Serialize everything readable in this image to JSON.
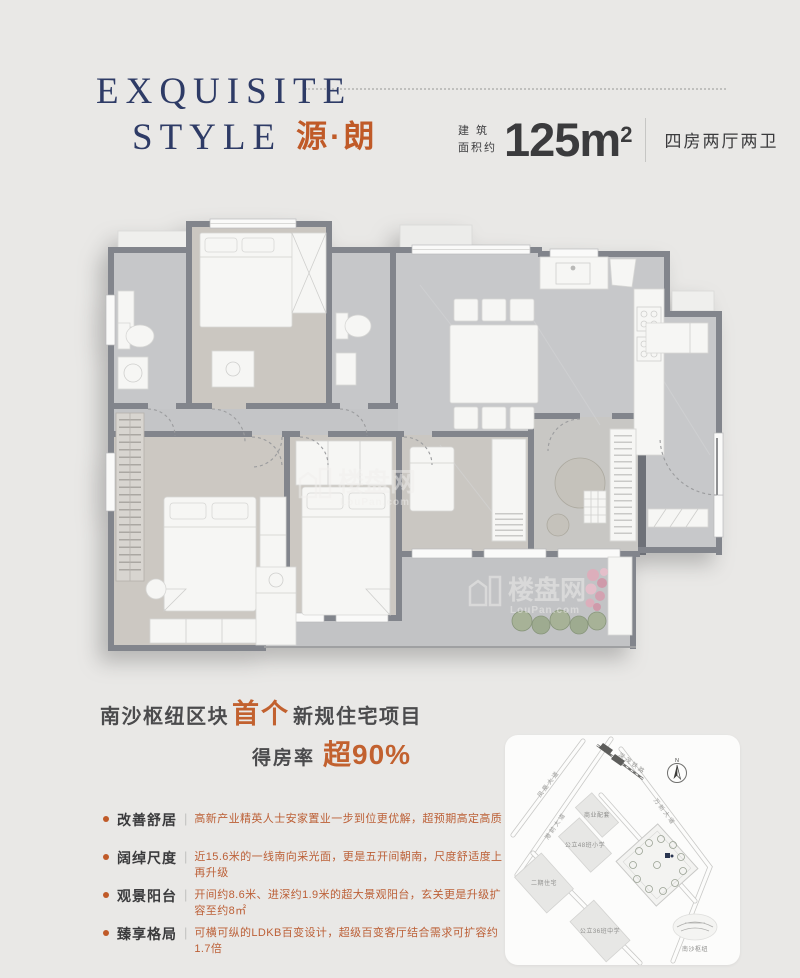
{
  "header": {
    "title_en_1": "EXQUISITE",
    "title_en_2": "STYLE",
    "title_cn": "源·朗",
    "area_prefix_top": "建 筑",
    "area_prefix_bottom": "面积约",
    "area_value": "125m",
    "area_sup": "2",
    "unit_type": "四房两厅两卫"
  },
  "floorplan": {
    "watermark": "楼盘网",
    "watermark_sub": "LouPan.com"
  },
  "tagline": {
    "pre": "南沙枢纽区块",
    "highlight": "首个",
    "post": "新规住宅项目"
  },
  "rate": {
    "label": "得房率",
    "value": "超90%"
  },
  "features": [
    {
      "label": "改善舒居",
      "desc": "高新产业精英人士安家置业一步到位更优解，超预期高定高质"
    },
    {
      "label": "阔绰尺度",
      "desc": "近15.6米的一线南向采光面，更是五开间朝南，尺度舒适度上再升级"
    },
    {
      "label": "观景阳台",
      "desc": "开间约8.6米、进深约1.9米的超大景观阳台，玄关更是升级扩容至约8㎡"
    },
    {
      "label": "臻享格局",
      "desc": "可横可纵的LDKB百变设计，超级百变客厅结合需求可扩容约1.7倍"
    }
  ],
  "map": {
    "compass": "N",
    "rail_label": "深茂铁路",
    "road1": "凤凰大道",
    "road2": "港前大道",
    "road3": "万新大道",
    "blocks": {
      "biz": "商业配套",
      "primary": "公立48班小学",
      "phase2": "二期住宅",
      "middle": "公立36班中学"
    },
    "station": "南沙枢纽"
  },
  "colors": {
    "navy": "#2e3b66",
    "orange": "#c2612f",
    "dark": "#3b3b3d",
    "wall": "#82858c",
    "background": "#e9e8e6"
  }
}
